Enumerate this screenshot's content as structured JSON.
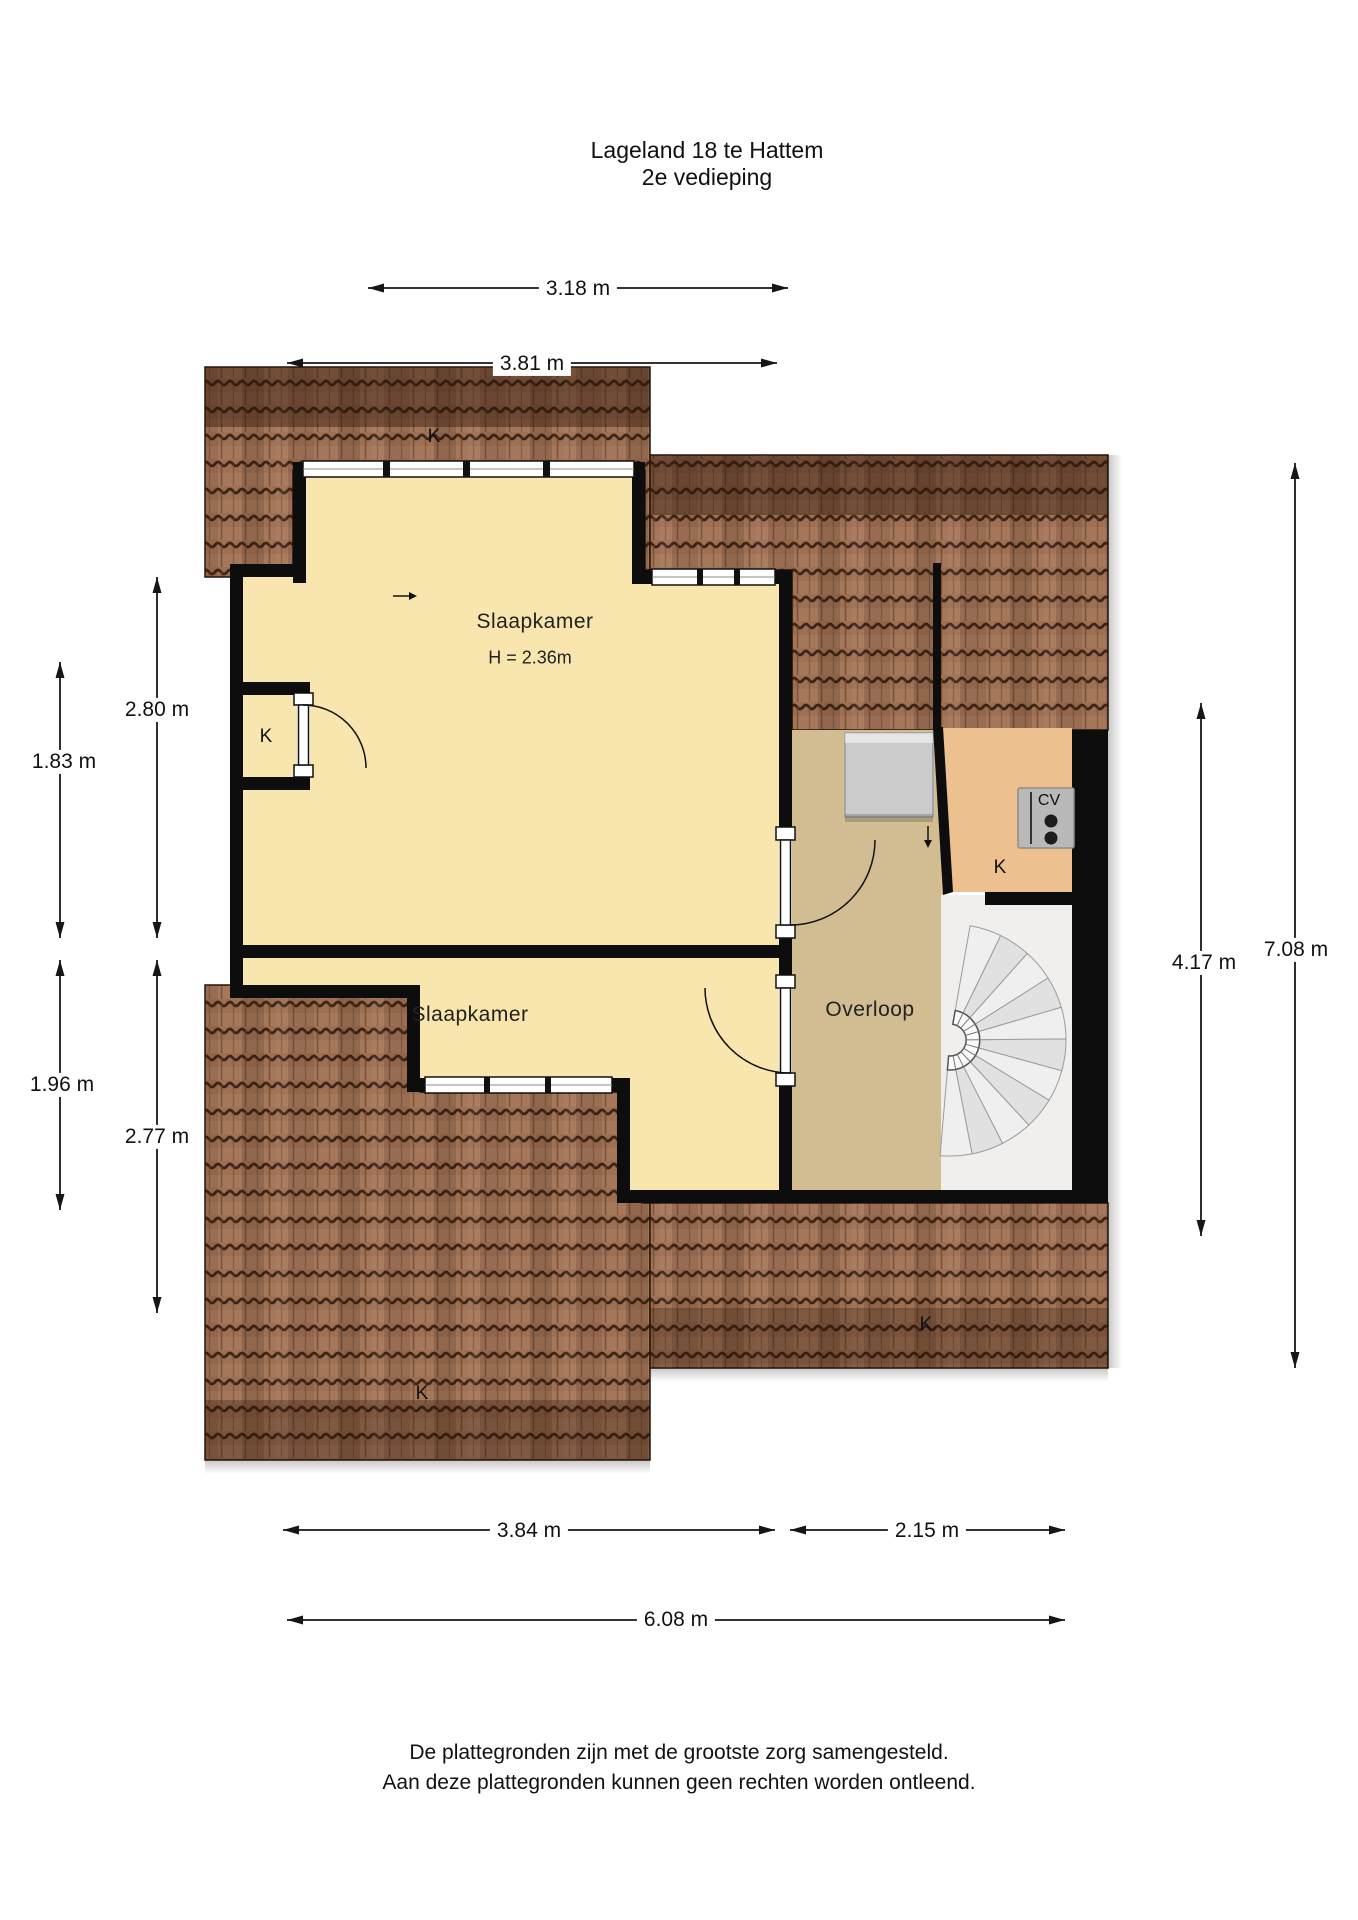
{
  "title": {
    "line1": "Lageland 18 te Hattem",
    "line2": "2e vedieping"
  },
  "dimensions": {
    "top_inner": "3.18 m",
    "top_outer": "3.81 m",
    "left_outer_upper": "2.80 m",
    "left_inner_upper": "1.83 m",
    "left_inner_lower": "1.96 m",
    "left_outer_lower": "2.77 m",
    "right_inner": "4.17 m",
    "right_outer": "7.08 m",
    "bottom_left": "3.84 m",
    "bottom_right": "2.15 m",
    "bottom_total": "6.08 m"
  },
  "rooms": {
    "bedroom_top": {
      "name": "Slaapkamer",
      "ceiling_height": "H = 2.36m"
    },
    "bedroom_bottom": {
      "name": "Slaapkamer"
    },
    "landing": {
      "name": "Overloop"
    },
    "boiler_label": "CV",
    "storage_labels": {
      "roof_top": "K",
      "left_closet": "K",
      "right_room": "K",
      "roof_bottom_left": "K",
      "roof_bottom_right": "K"
    }
  },
  "footer": {
    "line1": "De plattegronden zijn met de grootste zorg samengesteld.",
    "line2": "Aan deze plattegronden kunnen geen rechten worden ontleend."
  },
  "colors": {
    "room_yellow": "#f8e6ae",
    "landing_tan": "#d2bd92",
    "closet_orange": "#edc08f",
    "roof_brown": "#9d6f53",
    "wall_black": "#0d0d0d",
    "stairs_gray": "#e8e8e8"
  }
}
